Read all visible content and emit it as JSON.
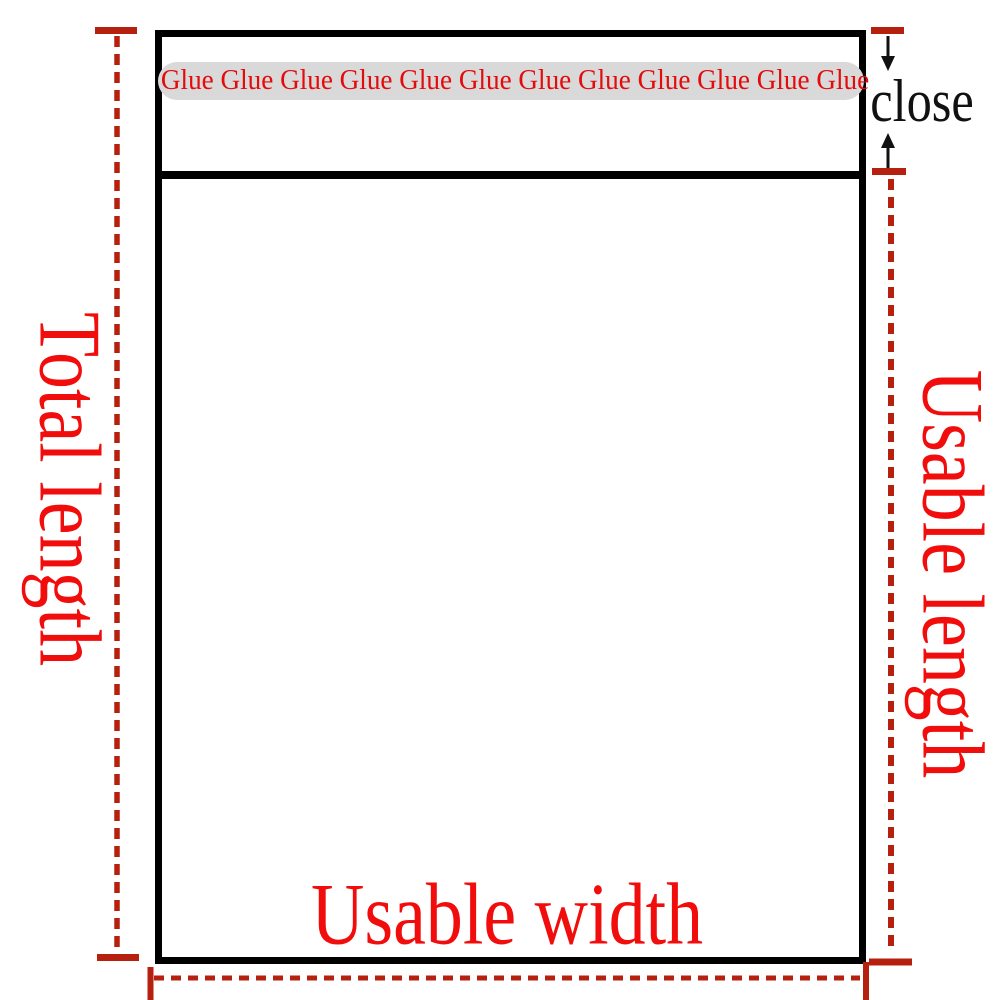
{
  "title": "Mailing bag dimension diagram",
  "colors": {
    "background": "#ffffff",
    "outline_black": "#000000",
    "close_text_black": "#111111",
    "label_red": "#f20d0d",
    "glue_text_red": "#e30b0b",
    "line_red": "#b5200f",
    "glue_strip_bg": "#d9d9d9"
  },
  "bag": {
    "glue_strip_text": "Glue Glue Glue Glue Glue Glue Glue Glue Glue Glue Glue Glue"
  },
  "labels": {
    "total_length": "Total length",
    "usable_length": "Usable length",
    "usable_width": "Usable width",
    "close": "close"
  },
  "icons": {
    "arrow_down": "arrow-down-icon",
    "arrow_up": "arrow-up-icon"
  }
}
